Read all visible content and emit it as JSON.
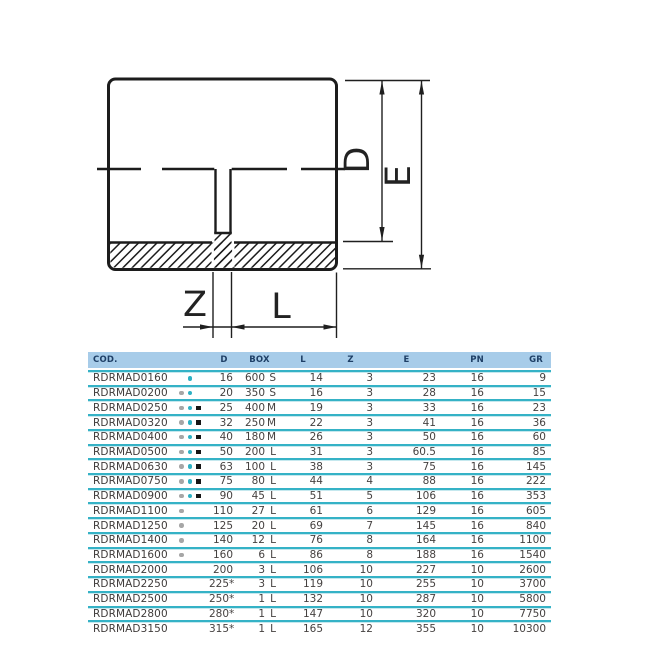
{
  "drawing": {
    "labels": {
      "d": "D",
      "e": "E",
      "z": "Z",
      "l": "L"
    }
  },
  "table": {
    "headers": [
      "COD.",
      "D",
      "BOX",
      "L",
      "Z",
      "E",
      "PN",
      "GR"
    ],
    "colors": {
      "header_bg": "#a7cce9",
      "header_text": "#1e3f66",
      "separator": "#35b2c6",
      "separator_light": "#c5e8ee",
      "row_text": "#454140",
      "mark_gray": "#a6a6a6",
      "mark_teal": "#2eb1c4",
      "mark_black": "#161616"
    },
    "rows": [
      {
        "cod": "RDRMAD0160",
        "marks": [
          "",
          "teal",
          ""
        ],
        "d": "16",
        "box": "600 S",
        "l": "14",
        "z": "3",
        "e": "23",
        "pn": "16",
        "gr": "9"
      },
      {
        "cod": "RDRMAD0200",
        "marks": [
          "gray",
          "teal",
          ""
        ],
        "d": "20",
        "box": "350 S",
        "l": "16",
        "z": "3",
        "e": "28",
        "pn": "16",
        "gr": "15"
      },
      {
        "cod": "RDRMAD0250",
        "marks": [
          "gray",
          "teal",
          "black"
        ],
        "d": "25",
        "box": "400 M",
        "l": "19",
        "z": "3",
        "e": "33",
        "pn": "16",
        "gr": "23"
      },
      {
        "cod": "RDRMAD0320",
        "marks": [
          "gray",
          "teal",
          "black"
        ],
        "d": "32",
        "box": "250 M",
        "l": "22",
        "z": "3",
        "e": "41",
        "pn": "16",
        "gr": "36"
      },
      {
        "cod": "RDRMAD0400",
        "marks": [
          "gray",
          "teal",
          "black"
        ],
        "d": "40",
        "box": "180 M",
        "l": "26",
        "z": "3",
        "e": "50",
        "pn": "16",
        "gr": "60"
      },
      {
        "cod": "RDRMAD0500",
        "marks": [
          "gray",
          "teal",
          "black"
        ],
        "d": "50",
        "box": "200 L",
        "l": "31",
        "z": "3",
        "e": "60.5",
        "pn": "16",
        "gr": "85"
      },
      {
        "cod": "RDRMAD0630",
        "marks": [
          "gray",
          "teal",
          "black"
        ],
        "d": "63",
        "box": "100 L",
        "l": "38",
        "z": "3",
        "e": "75",
        "pn": "16",
        "gr": "145"
      },
      {
        "cod": "RDRMAD0750",
        "marks": [
          "gray",
          "teal",
          "black"
        ],
        "d": "75",
        "box": "80 L",
        "l": "44",
        "z": "4",
        "e": "88",
        "pn": "16",
        "gr": "222"
      },
      {
        "cod": "RDRMAD0900",
        "marks": [
          "gray",
          "teal",
          "black"
        ],
        "d": "90",
        "box": "45 L",
        "l": "51",
        "z": "5",
        "e": "106",
        "pn": "16",
        "gr": "353"
      },
      {
        "cod": "RDRMAD1100",
        "marks": [
          "gray",
          "",
          ""
        ],
        "d": "110",
        "box": "27 L",
        "l": "61",
        "z": "6",
        "e": "129",
        "pn": "16",
        "gr": "605"
      },
      {
        "cod": "RDRMAD1250",
        "marks": [
          "gray",
          "",
          ""
        ],
        "d": "125",
        "box": "20 L",
        "l": "69",
        "z": "7",
        "e": "145",
        "pn": "16",
        "gr": "840"
      },
      {
        "cod": "RDRMAD1400",
        "marks": [
          "gray",
          "",
          ""
        ],
        "d": "140",
        "box": "12 L",
        "l": "76",
        "z": "8",
        "e": "164",
        "pn": "16",
        "gr": "1100"
      },
      {
        "cod": "RDRMAD1600",
        "marks": [
          "gray",
          "",
          ""
        ],
        "d": "160",
        "box": "6 L",
        "l": "86",
        "z": "8",
        "e": "188",
        "pn": "16",
        "gr": "1540"
      },
      {
        "cod": "RDRMAD2000",
        "marks": [
          "",
          "",
          ""
        ],
        "d": "200",
        "box": "3 L",
        "l": "106",
        "z": "10",
        "e": "227",
        "pn": "10",
        "gr": "2600"
      },
      {
        "cod": "RDRMAD2250",
        "marks": [
          "",
          "",
          ""
        ],
        "d": "225*",
        "box": "3 L",
        "l": "119",
        "z": "10",
        "e": "255",
        "pn": "10",
        "gr": "3700"
      },
      {
        "cod": "RDRMAD2500",
        "marks": [
          "",
          "",
          ""
        ],
        "d": "250*",
        "box": "1 L",
        "l": "132",
        "z": "10",
        "e": "287",
        "pn": "10",
        "gr": "5800"
      },
      {
        "cod": "RDRMAD2800",
        "marks": [
          "",
          "",
          ""
        ],
        "d": "280*",
        "box": "1 L",
        "l": "147",
        "z": "10",
        "e": "320",
        "pn": "10",
        "gr": "7750"
      },
      {
        "cod": "RDRMAD3150",
        "marks": [
          "",
          "",
          ""
        ],
        "d": "315*",
        "box": "1 L",
        "l": "165",
        "z": "12",
        "e": "355",
        "pn": "10",
        "gr": "10300"
      }
    ]
  }
}
